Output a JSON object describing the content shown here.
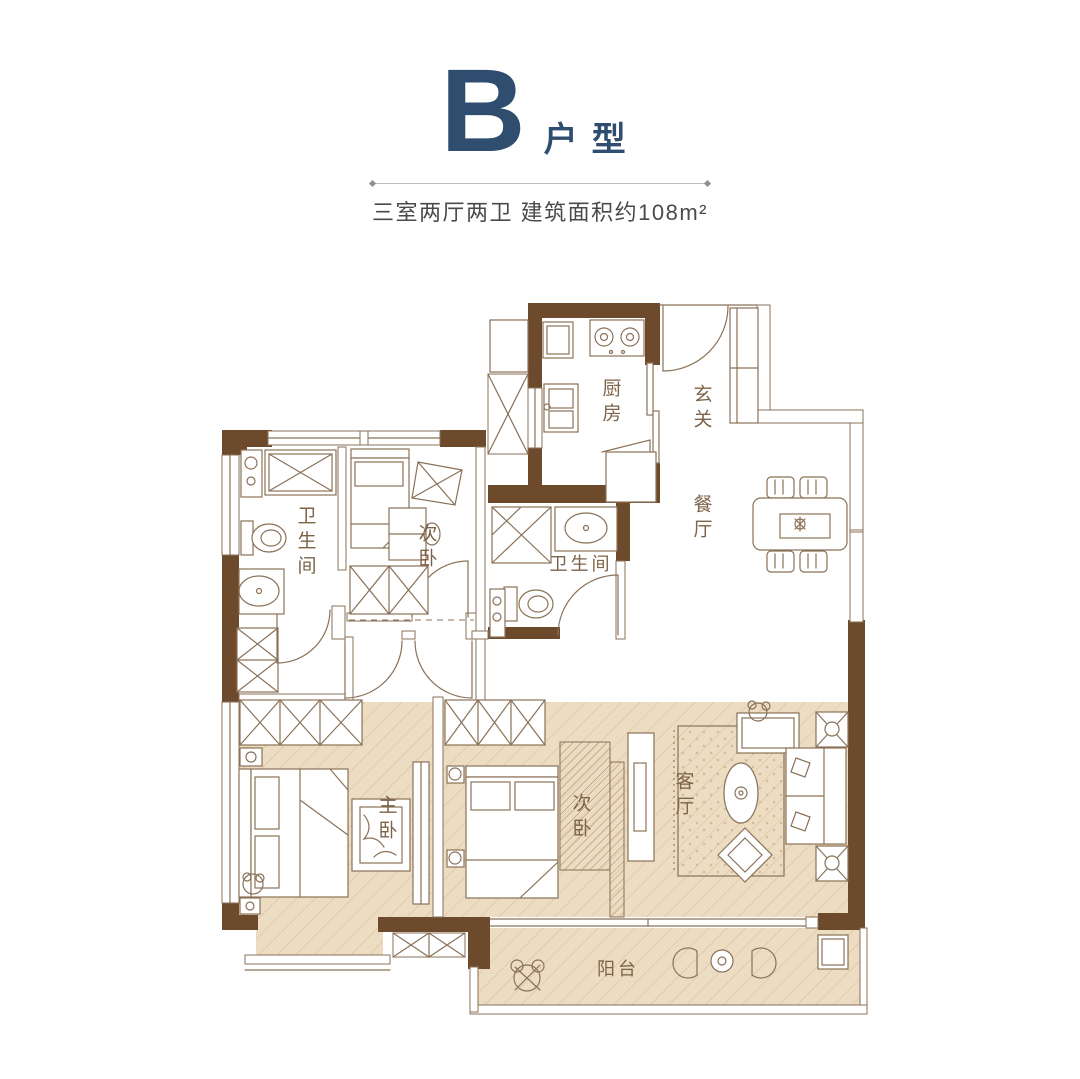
{
  "header": {
    "letter": "B",
    "suffix": "户型",
    "subtitle": "三室两厅两卫  建筑面积约108m²"
  },
  "rooms": {
    "kitchen": "厨房",
    "entry": "玄关",
    "dining": "餐厅",
    "bath_left": "卫生间",
    "bath_center": "卫生间",
    "bedroom_second_top": "次卧",
    "bedroom_master": "主卧",
    "bedroom_second_bottom": "次卧",
    "living": "客厅",
    "balcony": "阳台"
  },
  "colors": {
    "wall": "#6e4a2c",
    "line": "#8a7158",
    "highlight": "#ecdcc1",
    "hatchline": "#d3bd9b",
    "densehatch": "#a8886a",
    "title": "#2f4d6e",
    "subtitle": "#4a4a4a",
    "label": "#7d6347"
  }
}
